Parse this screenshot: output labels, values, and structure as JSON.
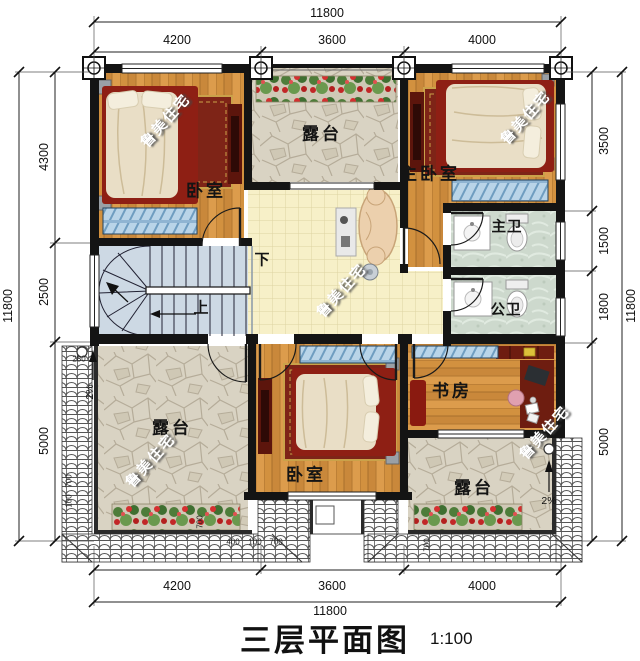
{
  "title": {
    "text": "三层平面图",
    "scale": "1:100"
  },
  "watermark": "鲁美住宅",
  "dimensions": {
    "top": {
      "total": "11800",
      "segments": [
        "4200",
        "3600",
        "4000"
      ]
    },
    "bottom": {
      "total": "11800",
      "segments": [
        "4200",
        "3600",
        "4000"
      ]
    },
    "left": {
      "total": "11800",
      "segments": [
        "4300",
        "2500",
        "5000"
      ]
    },
    "right": {
      "total": "11800",
      "segments": [
        "3500",
        "1500",
        "1800",
        "5000"
      ]
    }
  },
  "rooms": {
    "bedroom_top_left": "卧室",
    "terrace_top": "露台",
    "master_bedroom": "主卧室",
    "master_bath": "主卫",
    "public_bath": "公卫",
    "terrace_left": "露台",
    "bedroom_bottom": "卧室",
    "study": "书房",
    "terrace_bottom_right": "露台"
  },
  "stairs": {
    "down": "下",
    "up": "上"
  },
  "annotations": {
    "slope": "2%",
    "d280": "280",
    "d400": "400",
    "d100": "100",
    "d700": "700"
  },
  "colors": {
    "wall": "#141414",
    "wood": "#d2913f",
    "hall_tile": "#f7f0c8",
    "stone": "#d9d3c3",
    "stair": "#cdd9e4",
    "bath_tile": "#cdd9cd",
    "accent_red": "#8e1f14",
    "flower_red": "#c22727",
    "foliage_green": "#4e7d3a",
    "window_blue": "#b9d4e8"
  }
}
